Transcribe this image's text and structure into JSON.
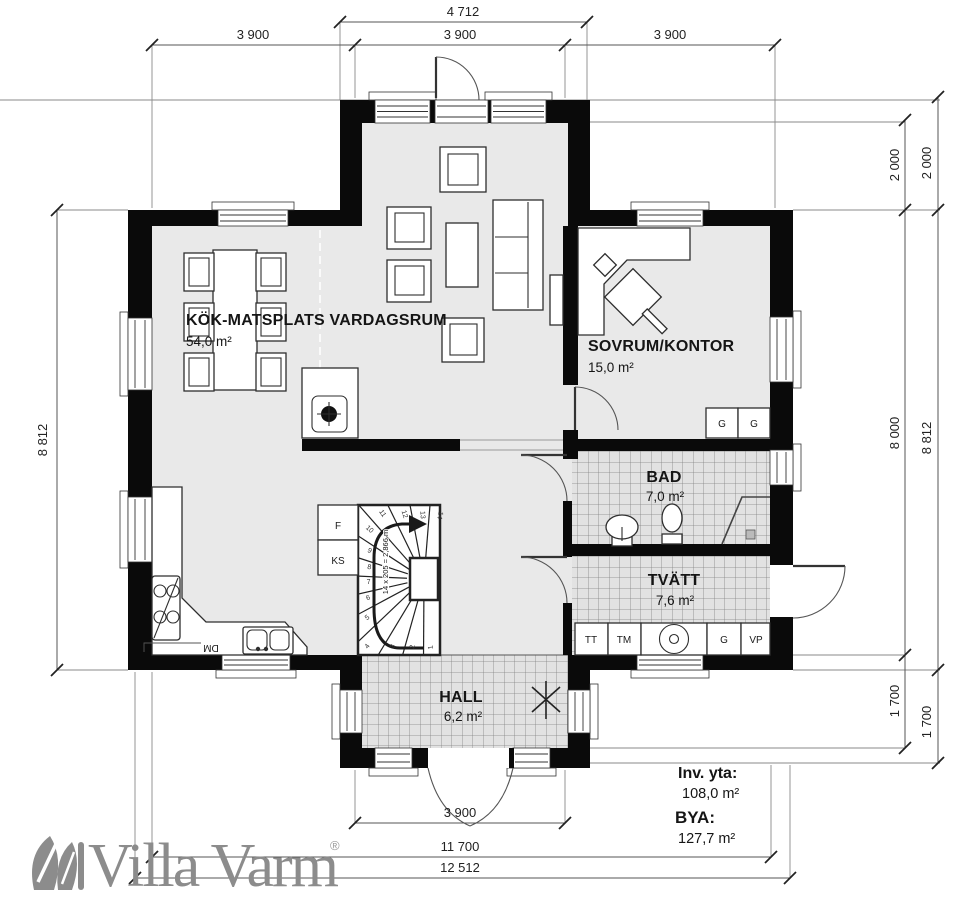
{
  "brand": {
    "name": "Villa Varm",
    "registered": "®"
  },
  "rooms": {
    "kitchen": {
      "name": "KÖK-MATSPLATS VARDAGSRUM",
      "area": "54,0 m²"
    },
    "bedroom": {
      "name": "SOVRUM/KONTOR",
      "area": "15,0 m²"
    },
    "bath": {
      "name": "BAD",
      "area": "7,0 m²"
    },
    "laundry": {
      "name": "TVÄTT",
      "area": "7,6 m²"
    },
    "hall": {
      "name": "HALL",
      "area": "6,2 m²"
    }
  },
  "totals": {
    "inv_label": "Inv. yta:",
    "inv_value": "108,0 m²",
    "bya_label": "BYA:",
    "bya_value": "127,7 m²"
  },
  "dimensions": {
    "d4712": "4 712",
    "d3900": "3 900",
    "d8812": "8 812",
    "d2000": "2 000",
    "d8000": "8 000",
    "d1700": "1 700",
    "d11700": "11 700",
    "d12512": "12 512"
  },
  "stair": {
    "note": "14 x 205 = 2,866 m",
    "treads": [
      "1",
      "2",
      "3",
      "4",
      "5",
      "6",
      "7",
      "8",
      "9",
      "10",
      "11",
      "12",
      "13",
      "14"
    ]
  },
  "appliances": {
    "freezer": "F",
    "fridge": "KS",
    "dishwasher": "DM",
    "dryer": "TT",
    "washer": "TM",
    "wardrobe": "G",
    "heater": "VP"
  },
  "colors": {
    "wall": "#0a0a0a",
    "floor": "#e9e9e9",
    "tile_line": "#808080",
    "logo": "#8c8c8c"
  }
}
